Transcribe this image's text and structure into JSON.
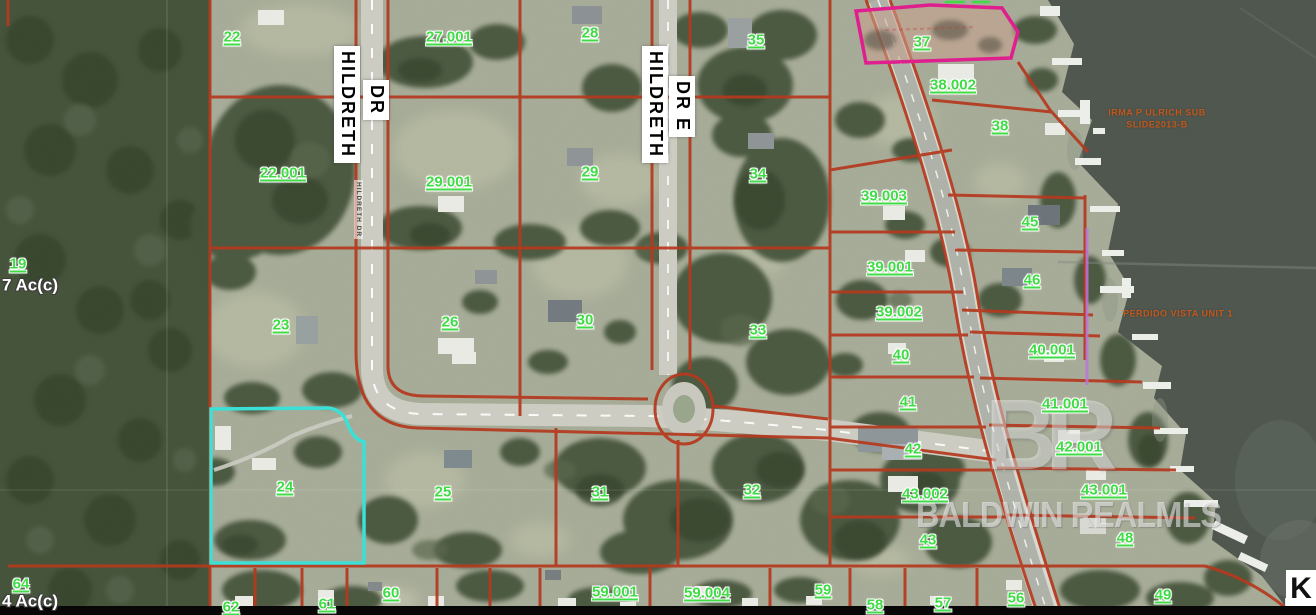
{
  "map": {
    "watermark": {
      "logo": "BR",
      "text": "BALDWIN REALMLS"
    },
    "corner_label": "K",
    "roads": {
      "hildreth": {
        "name": "HILDRETH",
        "suffix": "DR"
      },
      "hildreth_e": {
        "name": "HILDRETH",
        "suffix": "DR E"
      },
      "small_label": "HILDRETH DR"
    },
    "colors": {
      "parcel_line": "#b5391e",
      "highlight_parcel": "#3ce0d6",
      "flagged_parcel_outline": "#de1f8d",
      "parcel_label_green": "#3fdc46",
      "subdivision_text_orange": "#c2571c",
      "water": "#4f574f"
    },
    "labels": [
      {
        "text": "22",
        "x": 232,
        "y": 37,
        "kind": "parcel"
      },
      {
        "text": "27.001",
        "x": 449,
        "y": 37,
        "kind": "parcel"
      },
      {
        "text": "28",
        "x": 590,
        "y": 33,
        "kind": "parcel"
      },
      {
        "text": "35",
        "x": 756,
        "y": 40,
        "kind": "parcel"
      },
      {
        "text": "37",
        "x": 922,
        "y": 42,
        "kind": "parcel"
      },
      {
        "text": "38.002",
        "x": 953,
        "y": 85,
        "kind": "parcel"
      },
      {
        "text": "38",
        "x": 1000,
        "y": 126,
        "kind": "parcel"
      },
      {
        "text": "22.001",
        "x": 283,
        "y": 173,
        "kind": "parcel"
      },
      {
        "text": "29.001",
        "x": 449,
        "y": 182,
        "kind": "parcel"
      },
      {
        "text": "29",
        "x": 590,
        "y": 172,
        "kind": "parcel"
      },
      {
        "text": "34",
        "x": 758,
        "y": 174,
        "kind": "parcel"
      },
      {
        "text": "39.003",
        "x": 884,
        "y": 196,
        "kind": "parcel"
      },
      {
        "text": "45",
        "x": 1030,
        "y": 222,
        "kind": "parcel"
      },
      {
        "text": "19",
        "x": 18,
        "y": 264,
        "kind": "parcel"
      },
      {
        "text": "39.001",
        "x": 890,
        "y": 267,
        "kind": "parcel"
      },
      {
        "text": "46",
        "x": 1032,
        "y": 280,
        "kind": "parcel"
      },
      {
        "text": "23",
        "x": 281,
        "y": 325,
        "kind": "parcel"
      },
      {
        "text": "26",
        "x": 450,
        "y": 322,
        "kind": "parcel"
      },
      {
        "text": "30",
        "x": 585,
        "y": 320,
        "kind": "parcel"
      },
      {
        "text": "33",
        "x": 758,
        "y": 330,
        "kind": "parcel"
      },
      {
        "text": "39.002",
        "x": 899,
        "y": 312,
        "kind": "parcel"
      },
      {
        "text": "40",
        "x": 901,
        "y": 355,
        "kind": "parcel"
      },
      {
        "text": "40.001",
        "x": 1052,
        "y": 350,
        "kind": "parcel"
      },
      {
        "text": "41",
        "x": 908,
        "y": 402,
        "kind": "parcel"
      },
      {
        "text": "41.001",
        "x": 1065,
        "y": 404,
        "kind": "parcel"
      },
      {
        "text": "42",
        "x": 913,
        "y": 449,
        "kind": "parcel"
      },
      {
        "text": "42.001",
        "x": 1079,
        "y": 447,
        "kind": "parcel"
      },
      {
        "text": "43.002",
        "x": 925,
        "y": 494,
        "kind": "parcel"
      },
      {
        "text": "43.001",
        "x": 1104,
        "y": 490,
        "kind": "parcel"
      },
      {
        "text": "24",
        "x": 285,
        "y": 487,
        "kind": "parcel"
      },
      {
        "text": "25",
        "x": 443,
        "y": 492,
        "kind": "parcel"
      },
      {
        "text": "31",
        "x": 600,
        "y": 492,
        "kind": "parcel"
      },
      {
        "text": "32",
        "x": 752,
        "y": 490,
        "kind": "parcel"
      },
      {
        "text": "43",
        "x": 928,
        "y": 540,
        "kind": "parcel"
      },
      {
        "text": "48",
        "x": 1125,
        "y": 538,
        "kind": "parcel"
      },
      {
        "text": "64",
        "x": 21,
        "y": 584,
        "kind": "parcel"
      },
      {
        "text": "62",
        "x": 231,
        "y": 607,
        "kind": "parcel"
      },
      {
        "text": "61",
        "x": 327,
        "y": 604,
        "kind": "parcel"
      },
      {
        "text": "60",
        "x": 391,
        "y": 593,
        "kind": "parcel"
      },
      {
        "text": "59.001",
        "x": 615,
        "y": 592,
        "kind": "parcel"
      },
      {
        "text": "59.004",
        "x": 707,
        "y": 593,
        "kind": "parcel"
      },
      {
        "text": "59",
        "x": 823,
        "y": 590,
        "kind": "parcel"
      },
      {
        "text": "58",
        "x": 875,
        "y": 605,
        "kind": "parcel"
      },
      {
        "text": "57",
        "x": 943,
        "y": 603,
        "kind": "parcel"
      },
      {
        "text": "56",
        "x": 1016,
        "y": 598,
        "kind": "parcel"
      },
      {
        "text": "49",
        "x": 1163,
        "y": 595,
        "kind": "parcel"
      },
      {
        "text": "7 Ac(c)",
        "x": 30,
        "y": 285,
        "kind": "area"
      },
      {
        "text": "4 Ac(c)",
        "x": 30,
        "y": 601,
        "kind": "area"
      },
      {
        "text": "IRMA P ULRICH SUB",
        "x": 1157,
        "y": 113,
        "kind": "subdiv"
      },
      {
        "text": "SLIDE2013-B",
        "x": 1157,
        "y": 125,
        "kind": "subdiv"
      },
      {
        "text": "PERDIDO VISTA UNIT 1",
        "x": 1178,
        "y": 314,
        "kind": "subdiv"
      }
    ]
  }
}
